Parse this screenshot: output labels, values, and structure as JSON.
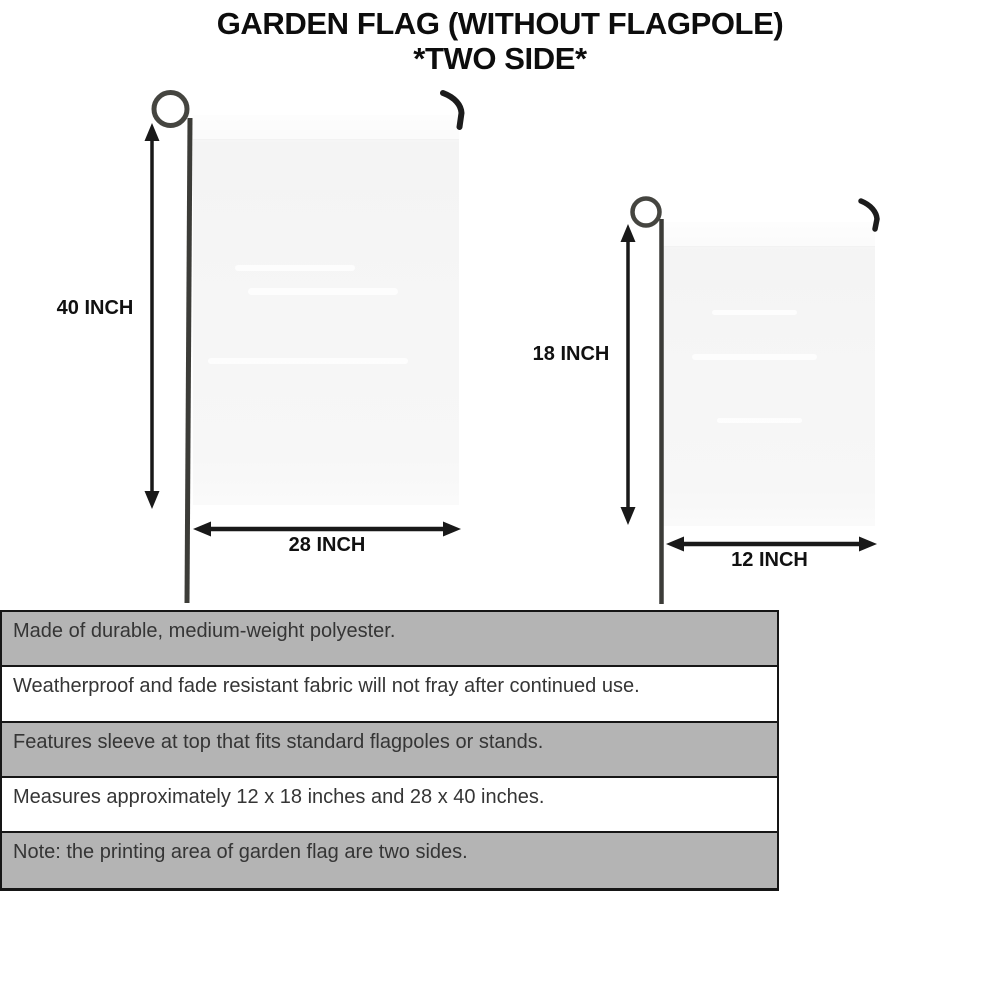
{
  "title": {
    "line1": "GARDEN FLAG (WITHOUT FLAGPOLE)",
    "line2": "*TWO SIDE*"
  },
  "flags": {
    "large": {
      "height_label": "40 INCH",
      "width_label": "28 INCH"
    },
    "small": {
      "height_label": "18 INCH",
      "width_label": "12 INCH"
    }
  },
  "features": [
    {
      "text": "Made of durable, medium-weight polyester."
    },
    {
      "text": "Weatherproof and fade resistant fabric will not fray after continued use."
    },
    {
      "text": "Features sleeve at top that fits standard flagpoles or stands."
    },
    {
      "text": "Measures approximately 12 x 18 inches and 28 x 40 inches."
    },
    {
      "text": "Note: the printing area of garden flag are two sides."
    }
  ],
  "colors": {
    "row_gray": "#b4b4b4",
    "row_white": "#ffffff",
    "table_border": "#161616",
    "flag_fill": "#f6f6f6",
    "pole": "#3c3c3c",
    "arrow": "#191919",
    "title_text": "#0d0d0d",
    "body_text": "#353535"
  }
}
